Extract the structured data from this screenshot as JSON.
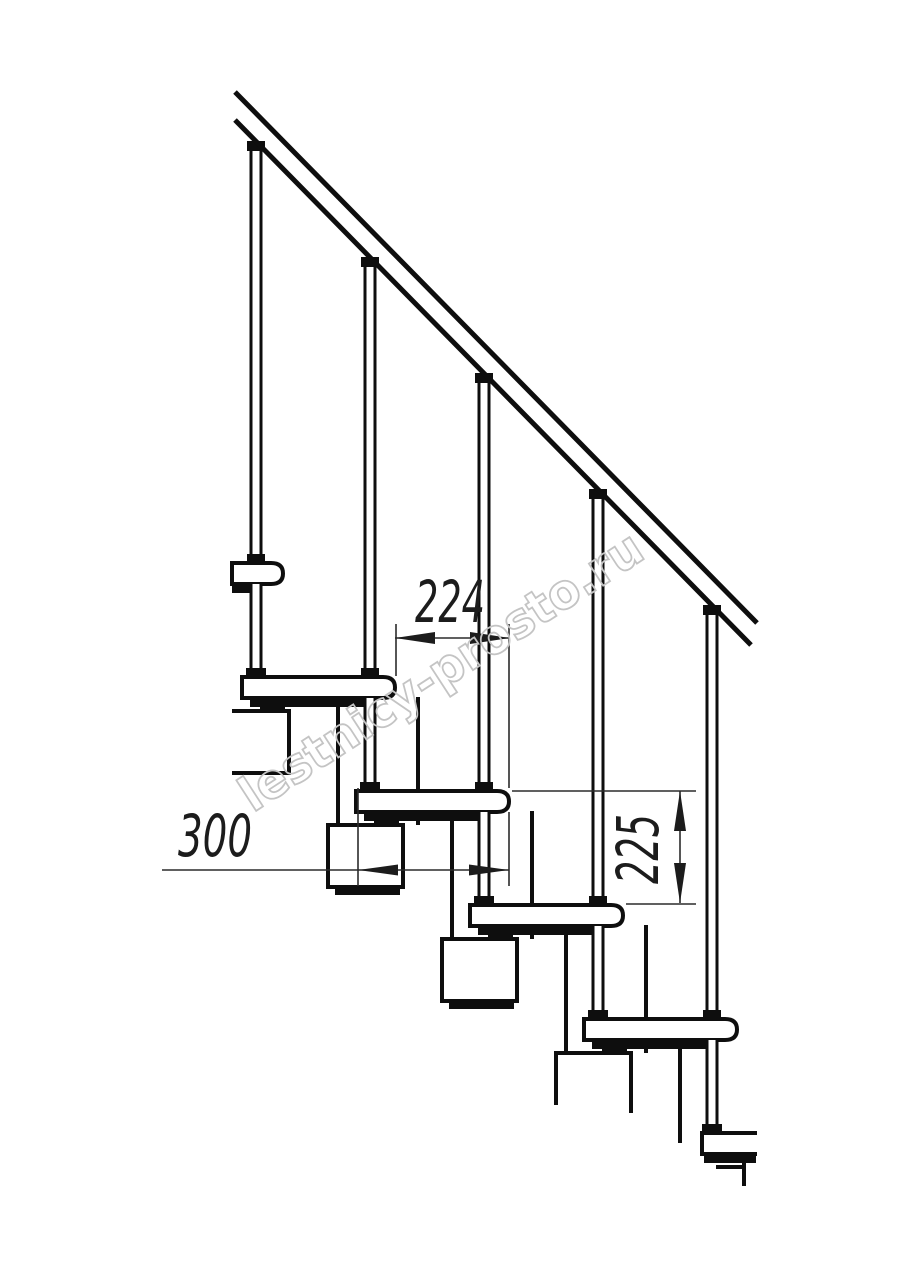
{
  "dimensions": {
    "going": "224",
    "tread_depth": "300",
    "rise": "225"
  },
  "watermark": {
    "text": "lestnicy-prosto.ru",
    "color": "#c4c4c4"
  },
  "colors": {
    "line": "#0e0e0e",
    "dimension": "#2b2b2b",
    "background": "#ffffff"
  },
  "structure": {
    "balusters": 5,
    "treads_visible": 6,
    "handrails": 1
  }
}
